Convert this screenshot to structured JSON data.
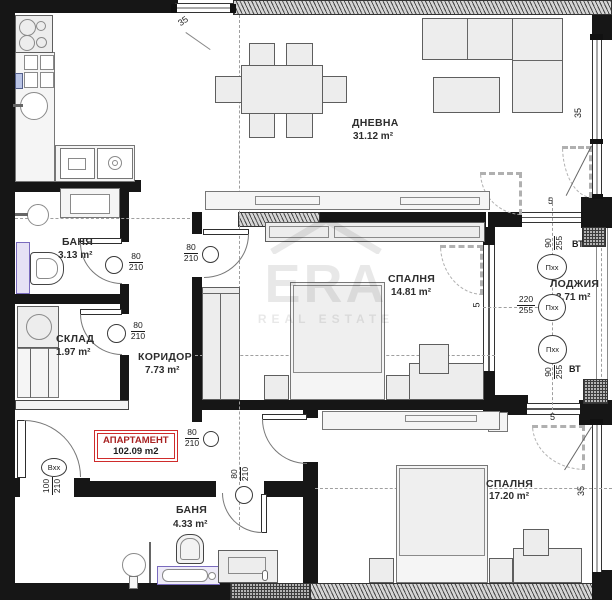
{
  "watermark": {
    "brand": "ERA",
    "subtitle": "REAL ESTATE"
  },
  "stamp": {
    "title": "АПАРТАМЕНТ",
    "area": "102.09 m2"
  },
  "rooms": {
    "living": {
      "name": "ДНЕВНА",
      "area": "31.12 m²"
    },
    "bath1": {
      "name": "БАНЯ",
      "area": "3.13 m²"
    },
    "storage": {
      "name": "СКЛАД",
      "area": "1.97 m²"
    },
    "corridor": {
      "name": "КОРИДОР",
      "area": "7.73 m²"
    },
    "bedroom1": {
      "name": "СПАЛНЯ",
      "area": "14.81 m²"
    },
    "loggia": {
      "name": "ЛОДЖИЯ",
      "area": "3.71 m²"
    },
    "bath2": {
      "name": "БАНЯ",
      "area": "4.33 m²"
    },
    "bedroom2": {
      "name": "СПАЛНЯ",
      "area": "17.20 m²"
    }
  },
  "doors": {
    "entrance": {
      "code": "Вхх",
      "w": "100",
      "h": "210"
    },
    "bedroom1": {
      "w": "80",
      "h": "210"
    },
    "bath1": {
      "w": "80",
      "h": "210"
    },
    "storage": {
      "w": "80",
      "h": "210"
    },
    "bedroom2": {
      "w": "80",
      "h": "210"
    },
    "bath2": {
      "w": "80",
      "h": "210"
    }
  },
  "windows": {
    "loggia_top": {
      "code": "Пхх",
      "w": "90",
      "h": "255"
    },
    "loggia_mid": {
      "code": "Пхх",
      "w": "220",
      "h": "255"
    },
    "loggia_bottom": {
      "code": "Пхх",
      "w": "90",
      "h": "255"
    },
    "vent_top": "ВТ",
    "vent_bottom": "ВТ"
  },
  "dimensions": {
    "kitchen_window": "35",
    "right_top": "35",
    "right_bottom": "35",
    "loggia_top": "5",
    "loggia_mid": "5",
    "loggia_bottom": "5"
  },
  "colors": {
    "wall": "#161616",
    "stamp_accent": "#cf2b2b",
    "fixture_accent": "#7a6bbe"
  }
}
